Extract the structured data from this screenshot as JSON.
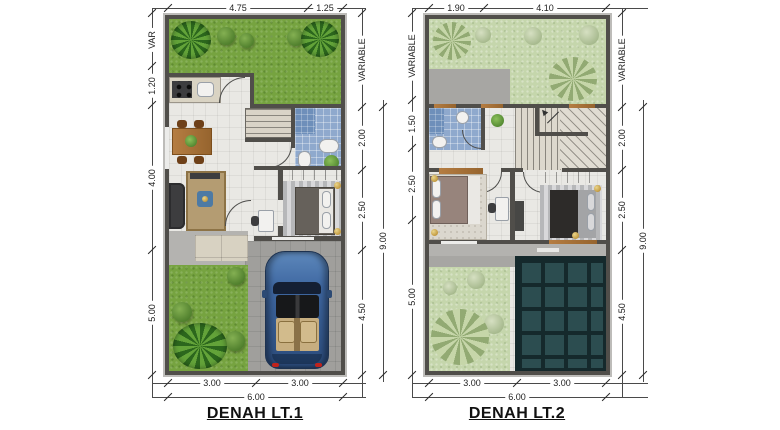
{
  "sheet": {
    "type": "architectural-floor-plan",
    "background": "#ffffff"
  },
  "plans": [
    {
      "title": "DENAH LT.1",
      "dims": {
        "top": [
          "4.75",
          "1.25"
        ],
        "left": [
          "VAR",
          "1.20",
          "4.00",
          "5.00"
        ],
        "right": [
          "VARIABLE",
          "2.00",
          "2.50",
          "4.50"
        ],
        "right_total": "9.00",
        "bottom": [
          "3.00",
          "3.00"
        ],
        "bottom_total": "6.00"
      },
      "depicted": [
        "front-garden",
        "kitchen",
        "dining-table",
        "stairs",
        "bathroom",
        "living-room",
        "bedroom",
        "terrace",
        "rear-garden",
        "carport",
        "car"
      ]
    },
    {
      "title": "DENAH LT.2",
      "dims": {
        "top": [
          "1.90",
          "4.10"
        ],
        "left": [
          "VARIABLE",
          "1.50",
          "2.50",
          "5.00"
        ],
        "right": [
          "VARIABLE",
          "2.00",
          "2.50",
          "4.50"
        ],
        "right_total": "9.00",
        "bottom": [
          "3.00",
          "3.00"
        ],
        "bottom_total": "6.00"
      },
      "depicted": [
        "garden-below",
        "roof-deck",
        "bathroom",
        "stairs",
        "master-bedroom",
        "bedroom-2",
        "desk",
        "balcony-deck",
        "glass-canopy-roof"
      ]
    }
  ],
  "colors": {
    "grass": "#76a340",
    "grass_pale": "#c5d6ac",
    "wall": "#504e4a",
    "floor_tile": "#e9e8e4",
    "bath_tile_blue": "#8fa9cd",
    "wood": "#a9743c",
    "paving_gray": "#a09f9c",
    "terrace_tile": "#d8d2c2",
    "glass_roof": "#2c4d50",
    "car_body_blue": "#3f68a2",
    "car_seat_tan": "#c7ae80",
    "dimension_text": "#222222"
  }
}
